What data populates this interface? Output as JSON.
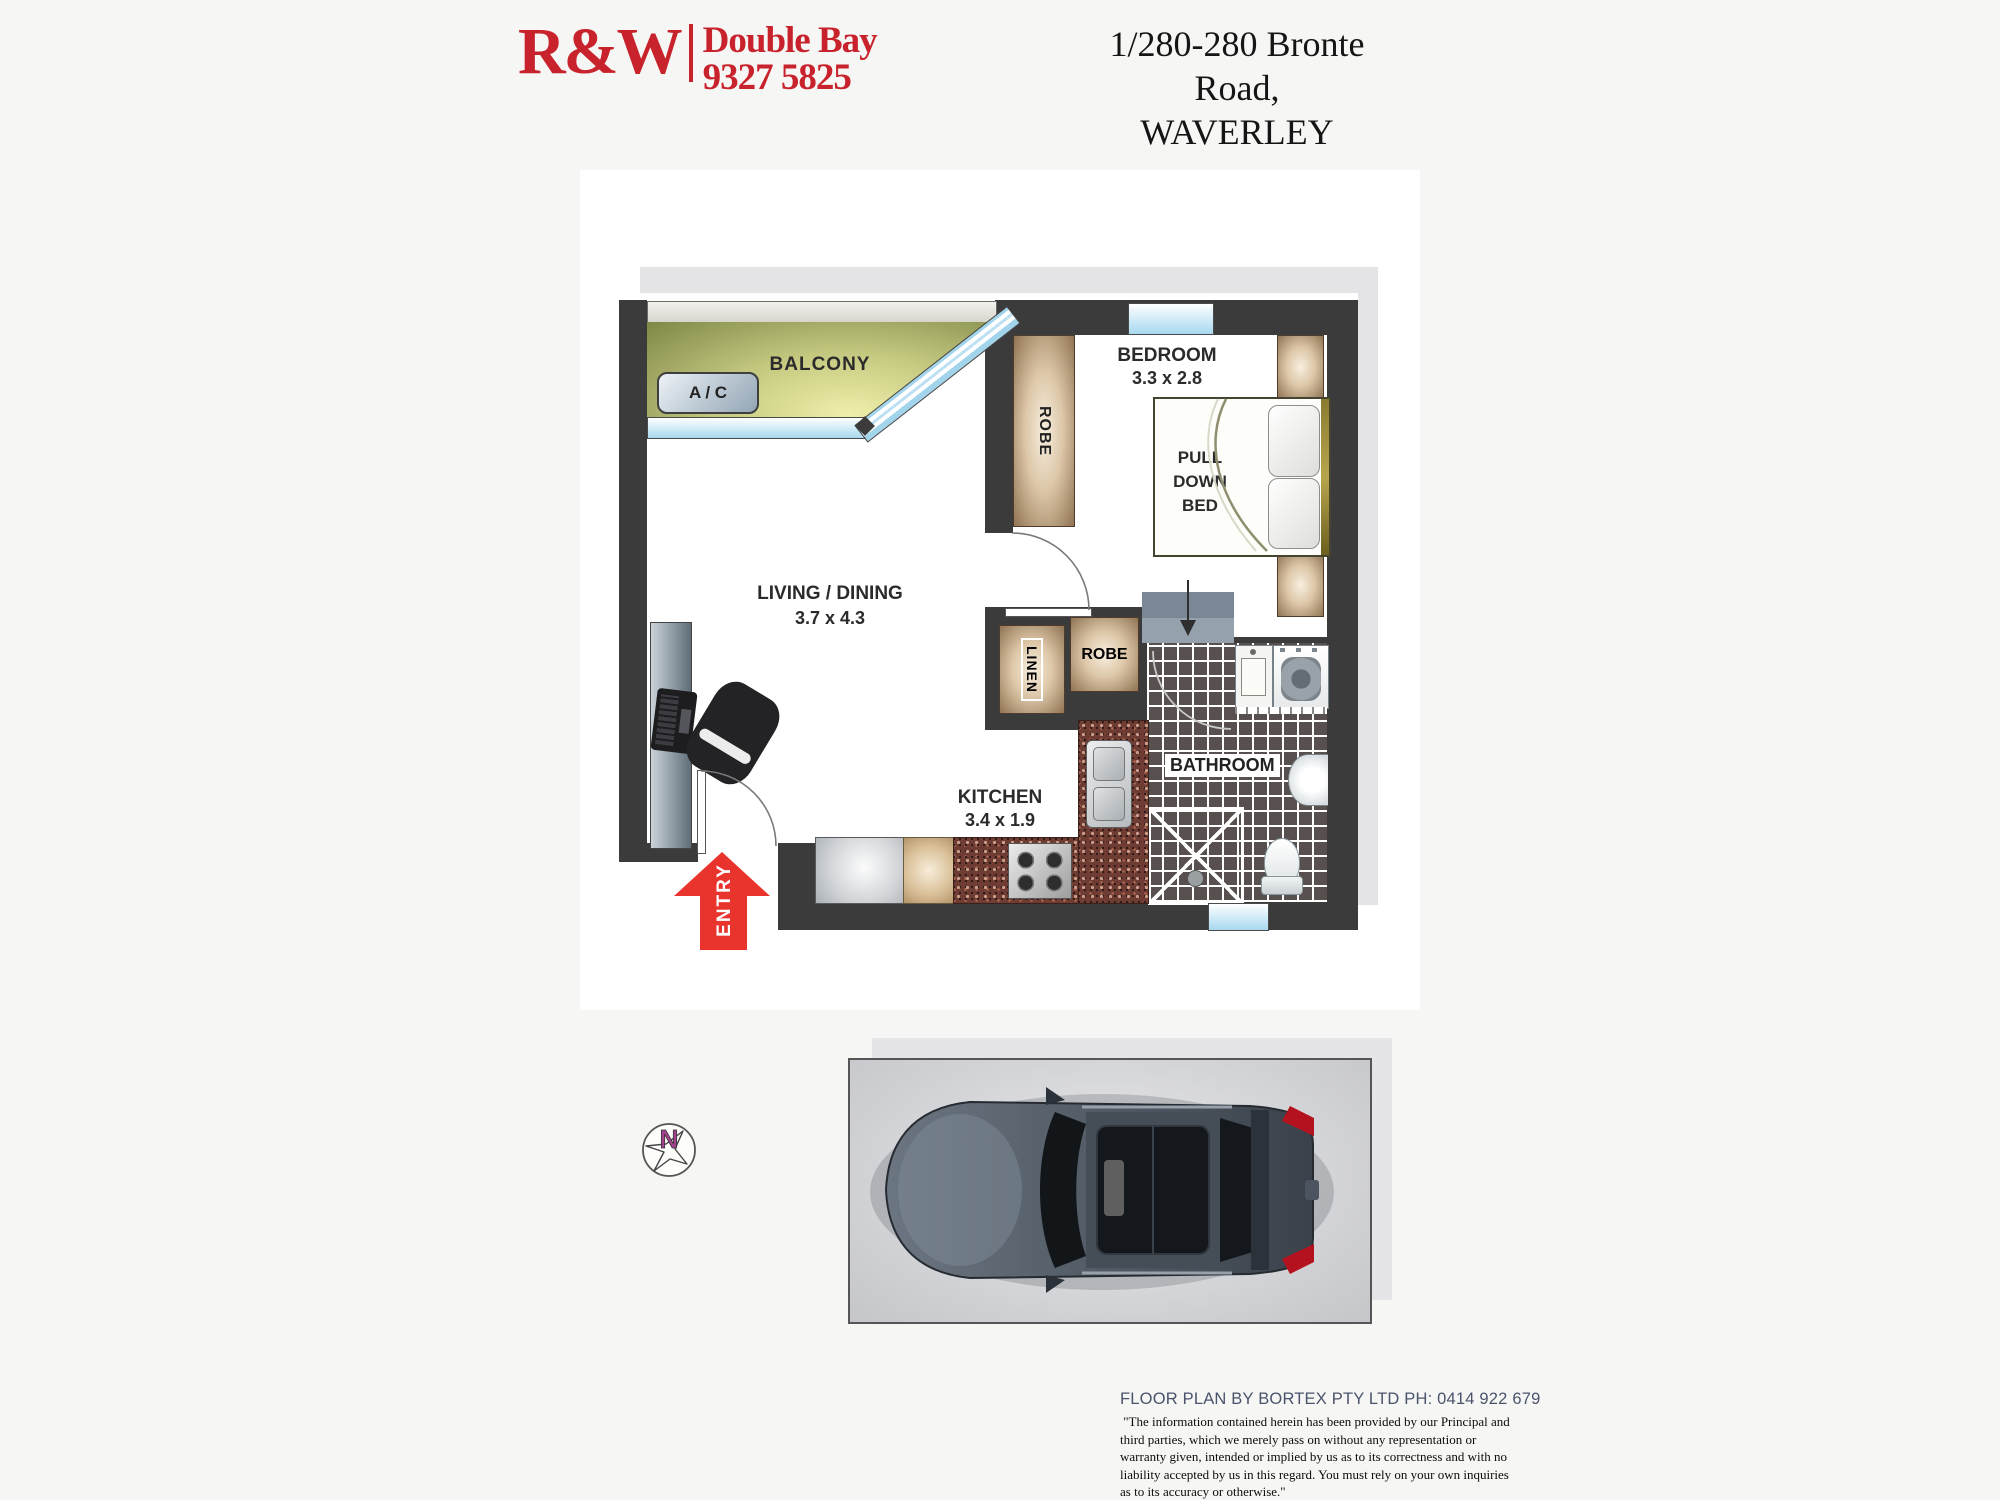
{
  "header": {
    "brand": "R&W",
    "office": "Double Bay",
    "phone": "9327 5825",
    "address_line1": "1/280-280 Bronte Road,",
    "address_line2": "WAVERLEY"
  },
  "plan": {
    "balcony": "BALCONY",
    "ac": "A / C",
    "bedroom_name": "BEDROOM",
    "bedroom_dims": "3.3 x 2.8",
    "pull_down_bed": "PULL DOWN BED",
    "robe_bedroom": "ROBE",
    "robe_hall": "ROBE",
    "linen": "LINEN",
    "living_name": "LIVING / DINING",
    "living_dims": "3.7 x 4.3",
    "kitchen_name": "KITCHEN",
    "kitchen_dims": "3.4 x 1.9",
    "bathroom": "BATHROOM",
    "entry": "ENTRY",
    "compass_north": "N"
  },
  "footer": {
    "credit": "FLOOR PLAN BY BORTEX PTY LTD PH: 0414 922 679",
    "disclaimer_lines": [
      " \"The information contained herein has been provided by our Principal and",
      "third parties, which we merely pass on without any representation or",
      "warranty given, intended or implied by us as to its correctness and with no",
      "liability accepted by us in this regard. You must rely on your own inquiries",
      "as to its accuracy or otherwise.\""
    ]
  },
  "colors": {
    "brand_red": "#c8232c",
    "entry_arrow_red": "#e9342e",
    "compass_purple": "#a3438f",
    "wall": "#3b3b3b"
  }
}
